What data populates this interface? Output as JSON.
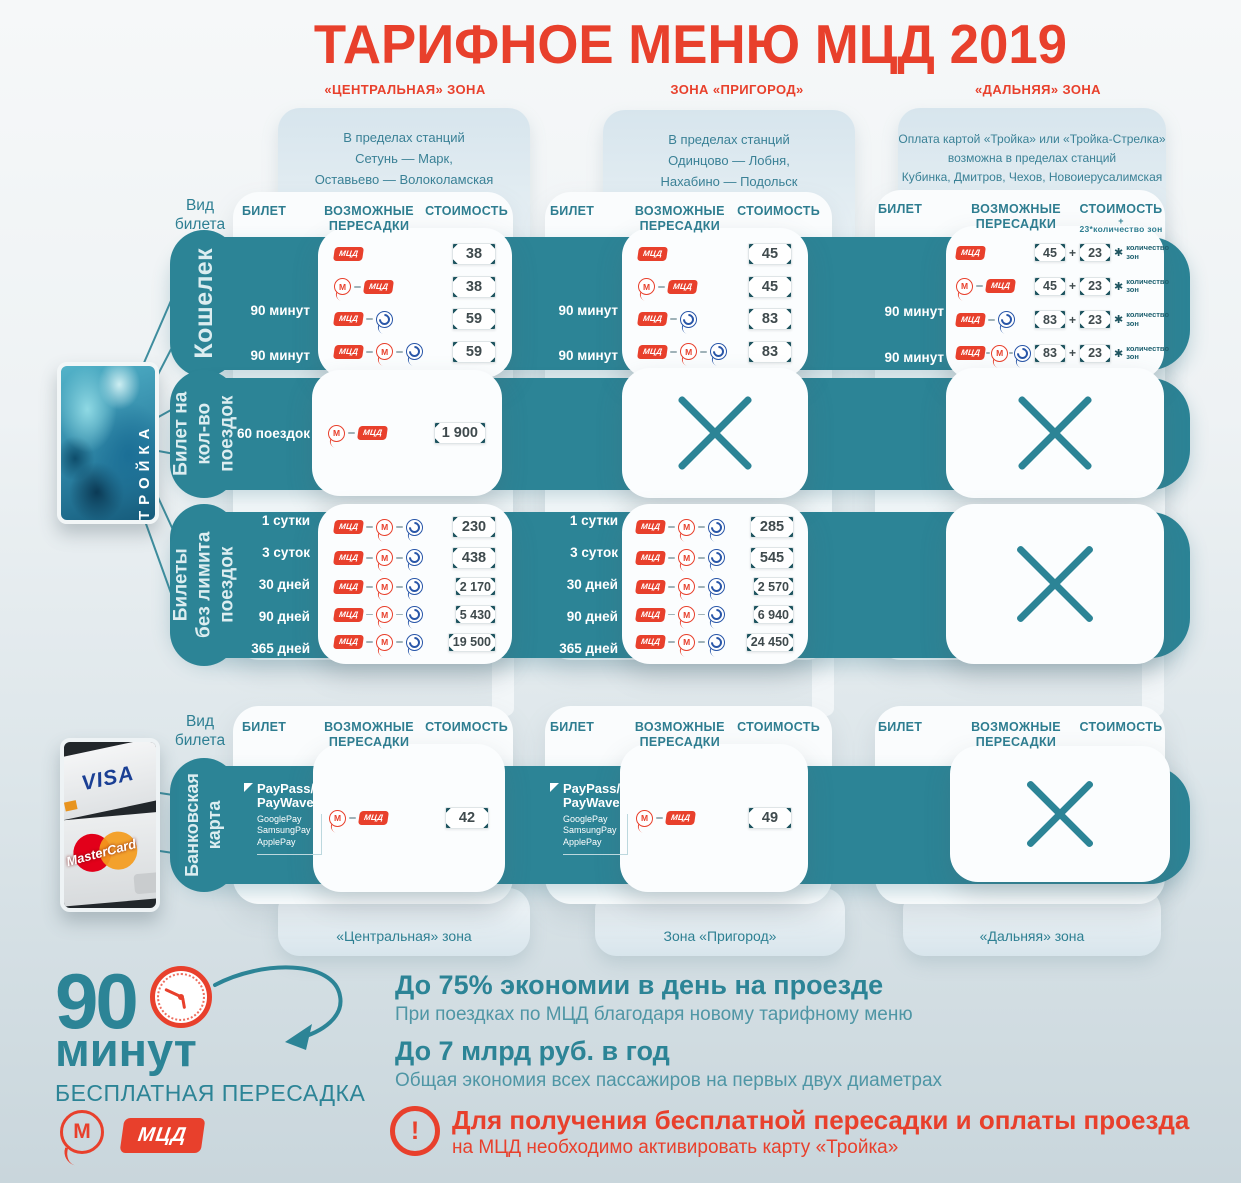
{
  "title": "ТАРИФНОЕ МЕНЮ МЦД 2019",
  "zones": [
    {
      "header": "«ЦЕНТРАЛЬНАЯ» ЗОНА",
      "desc": [
        "В пределах станций",
        "Сетунь — Марк,",
        "Оставьево — Волоколамская"
      ],
      "footer": "«Центральная» зона"
    },
    {
      "header": "ЗОНА «ПРИГОРОД»",
      "desc": [
        "В пределах станций",
        "Одинцово — Лобня,",
        "Нахабино — Подольск"
      ],
      "footer": "Зона «Пригород»"
    },
    {
      "header": "«ДАЛЬНЯЯ» ЗОНА",
      "desc": [
        "Оплата картой «Тройка» или «Тройка-Стрелка»",
        "возможна в пределах станций",
        "Кубинка, Дмитров, Чехов, Новоиерусалимская"
      ],
      "footer": "«Дальняя» зона"
    }
  ],
  "headers": {
    "kind": "Вид билета",
    "ticket": "БИЛЕТ",
    "transfers": "ВОЗМОЖНЫЕ ПЕРЕСАДКИ",
    "price": "СТОИМОСТЬ",
    "price_plus": "+",
    "zone_formula": "23*количество зон"
  },
  "mult": {
    "plus": "+",
    "star": "✱",
    "label_1": "количество",
    "label_2": "зон"
  },
  "bands": [
    {
      "name": "Кошелек",
      "label_lines": [
        "Кошелек"
      ],
      "tickets": [
        "",
        "",
        "90 минут",
        "90 минут"
      ],
      "central": [
        "38",
        "38",
        "59",
        "59"
      ],
      "suburb": [
        "45",
        "45",
        "83",
        "83"
      ],
      "far": [
        "45",
        "45",
        "83",
        "83"
      ],
      "far_zone": "23"
    },
    {
      "name": "Билет на кол-во поездок",
      "label_lines": [
        "Билет на",
        "кол-во",
        "поездок"
      ],
      "tickets": [
        "60 поездок"
      ],
      "central": [
        "1 900"
      ]
    },
    {
      "name": "Билеты без лимита поездок",
      "label_lines": [
        "Билеты",
        "без лимита",
        "поездок"
      ],
      "tickets": [
        "1 сутки",
        "3 суток",
        "30 дней",
        "90 дней",
        "365 дней"
      ],
      "central": [
        "230",
        "438",
        "2 170",
        "5 430",
        "19 500"
      ],
      "suburb": [
        "285",
        "545",
        "2 570",
        "6 940",
        "24 450"
      ]
    },
    {
      "name": "Банковская карта",
      "label_lines": [
        "Банковская",
        "карта"
      ],
      "payment": {
        "line1": "PayPass/",
        "line2": "PayWave",
        "wallets": [
          "GooglePay",
          "SamsungPay",
          "ApplePay"
        ]
      },
      "central": [
        "42"
      ],
      "suburb": [
        "49"
      ]
    }
  ],
  "icons": {
    "mcd": "МЦД",
    "metro": "М"
  },
  "troika": {
    "label": "ТРОЙКА"
  },
  "bank": {
    "visa": "VISA",
    "mastercard": "MasterCard"
  },
  "footer": {
    "minutes_number": "90",
    "minutes_word": "минут",
    "free_transfer": "БЕСПЛАТНАЯ ПЕРЕСАДКА",
    "s1_title": "До 75% экономии в день на проезде",
    "s1_sub": "При поездках по МЦД благодаря новому тарифному меню",
    "s2_title": "До 7 млрд руб. в год",
    "s2_sub": "Общая экономия всех пассажиров на первых двух диаметрах",
    "notice_mark": "!",
    "notice_title": "Для получения бесплатной пересадки и оплаты проезда",
    "notice_sub": "на МЦД необходимо активировать карту «Тройка»"
  },
  "colors": {
    "red": "#e8402c",
    "teal": "#2c8496",
    "panel": "#fafcfd",
    "light_blue": "#dce8ef",
    "blue_icon": "#2856a8"
  }
}
